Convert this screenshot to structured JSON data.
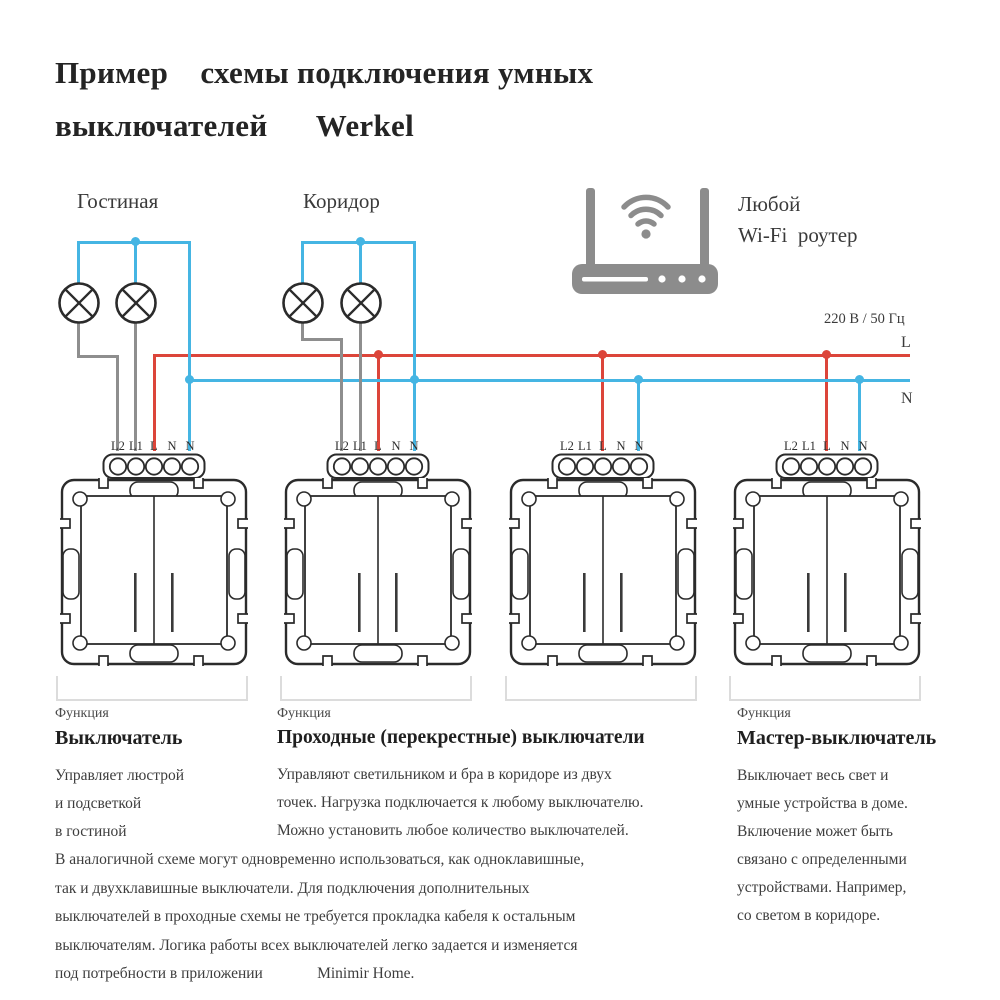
{
  "title": "Пример    схемы подключения умных\nвыключателей      Werkel",
  "labels": {
    "room1": "Гостиная",
    "room2": "Коридор",
    "router": "Любой\nWi-Fi  роутер",
    "power": "220 В / 50 Гц",
    "line_l": "L",
    "line_n": "N"
  },
  "terminal_labels": [
    "L2",
    "L1",
    "L",
    "N",
    "N"
  ],
  "switches": [
    {
      "id": "switch-living-room",
      "x": 154
    },
    {
      "id": "switch-corridor-1",
      "x": 378
    },
    {
      "id": "switch-corridor-2",
      "x": 603
    },
    {
      "id": "switch-master",
      "x": 827
    }
  ],
  "captions": [
    {
      "eyebrow": "Функция",
      "title": "Выключатель",
      "body": "Управляет люстрой\nи подсветкой\nв гостиной"
    },
    {
      "eyebrow": "Функция",
      "title": "Проходные (перекрестные) выключатели",
      "body": "Управляют светильником и бра в коридоре из двух\nточек. Нагрузка подключается к любому выключателю.\nМожно установить любое количество выключателей."
    },
    {
      "eyebrow": "Функция",
      "title": "Мастер-выключатель",
      "body": "Выключает весь свет и\nумные устройства в доме.\nВключение может быть\nсвязано с определенными\nустройствами. Например,\nсо светом в коридоре."
    }
  ],
  "footer": "В аналогичной схеме могут одновременно использоваться, как одноклавишные,\nтак и двухклавишные выключатели. Для подключения дополнительных\nвыключателей в проходные схемы не требуется прокладка кабеля к остальным\nвыключателям. Логика работы всех выключателей легко задается и изменяется\nпод потребности в приложении              Minimir Home.",
  "colors": {
    "wire_live": "#dc453a",
    "wire_neutral": "#45b5e3",
    "wire_switched": "#8e8e8e",
    "router": "#8c8c8c",
    "ink": "#2b2b2b"
  }
}
